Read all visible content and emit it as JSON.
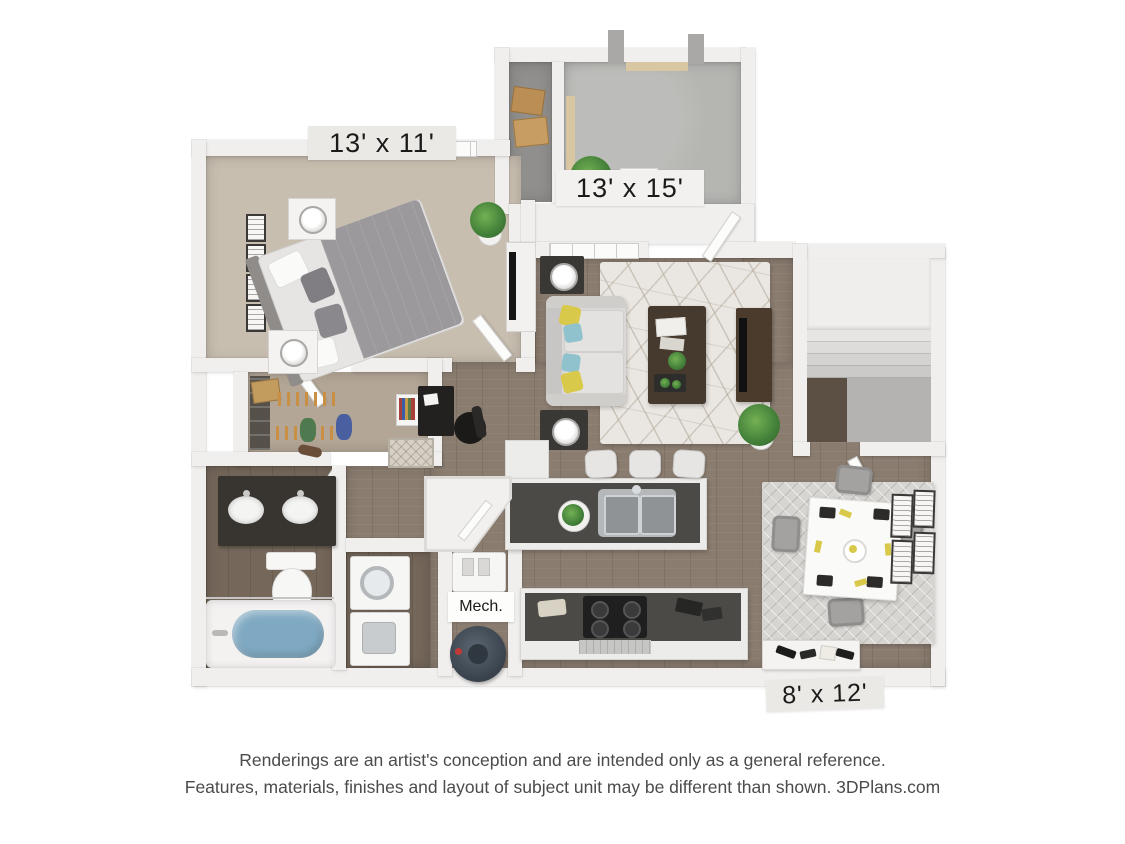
{
  "labels": {
    "bedroom_dimensions": "13' x 11'",
    "living_dimensions": "13' x 15'",
    "patio_dimensions": "8' x 12'",
    "mech_room": "Mech."
  },
  "footer": {
    "line1": "Renderings are an artist's conception and are intended only as a general reference.",
    "line2": "Features, materials, finishes and layout of subject unit may be different than shown. 3DPlans.com"
  },
  "colors": {
    "wall": "#f0efed",
    "carpet": "#c8beb0",
    "closet_carpet": "#b3a696",
    "wood": "#8a7c6f",
    "bath_wood": "#75675a",
    "concrete": "#b5b5b2",
    "water": "#7fa9c2",
    "accent_yellow": "#d9c94a",
    "accent_teal": "#8fc2cc",
    "counter_top": "#4c4a47",
    "espresso": "#383430"
  }
}
